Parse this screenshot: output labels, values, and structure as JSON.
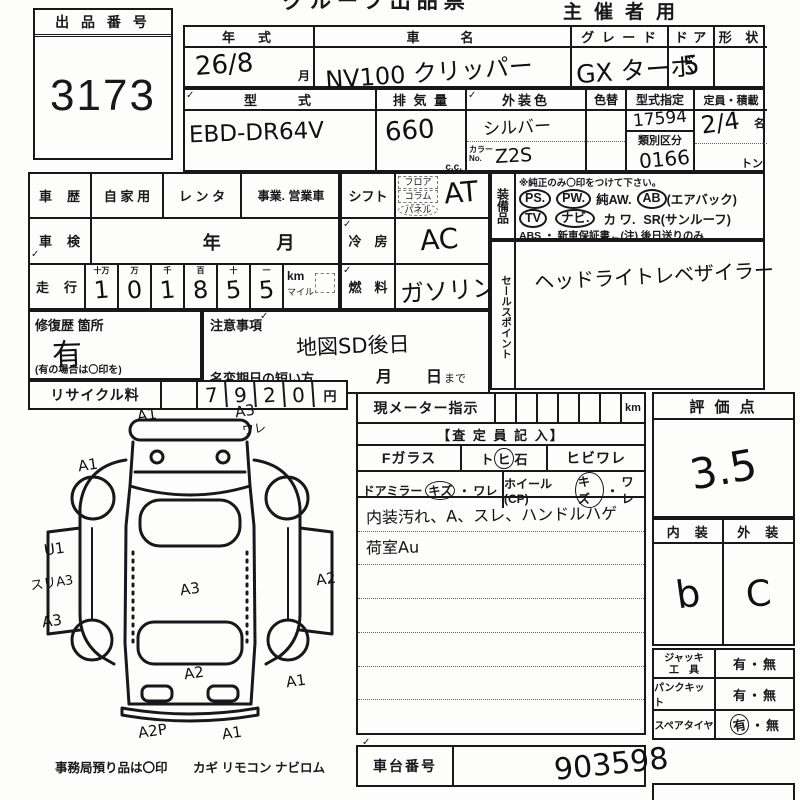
{
  "colors": {
    "paper": "#fdfdfb",
    "ink": "#17171c"
  },
  "header": {
    "title": "グループ出品票",
    "corner": "主催者用"
  },
  "marks": {
    "tick": "✓"
  },
  "exhibit": {
    "label": "出 品 番 号",
    "number": "3173"
  },
  "top": {
    "year": {
      "label": "年　式",
      "value": "26/8",
      "unit": "月"
    },
    "name": {
      "label": "車　　名",
      "value": "NV100 クリッパー"
    },
    "grade": {
      "label": "グ レ ー ド",
      "value": "GX ターボ"
    },
    "door": {
      "label": "ド ア",
      "value": "5"
    },
    "shape": {
      "label": "形 状",
      "value": ""
    },
    "model": {
      "label": "型　　式",
      "value": "EBD-DR64V"
    },
    "disp": {
      "label": "排 気 量",
      "value": "660",
      "unit": "c.c."
    },
    "color": {
      "label": "外装色",
      "value": "シルバー",
      "no_label": "カラーNo.",
      "no_value": "Z2S"
    },
    "recolor": {
      "label": "色替",
      "value": ""
    },
    "approval": {
      "label": "型式指定",
      "value": "17594",
      "sub_label": "類別区分",
      "sub_value": "0166"
    },
    "capacity": {
      "label": "定員・積載",
      "value": "2/4",
      "unit": "名",
      "ton": "トン"
    }
  },
  "history": {
    "label": "車　歴",
    "opt1": "自 家 用",
    "opt2": "レ ン タ",
    "opt3": "事業. 営業車",
    "inspection": {
      "label": "車　検",
      "year": "年",
      "month": "月"
    },
    "mileage": {
      "label": "走　行",
      "headers": [
        "十万",
        "万",
        "千",
        "百",
        "十",
        "一"
      ],
      "digits": [
        "1",
        "0",
        "1",
        "8",
        "5",
        "5"
      ],
      "km": "km",
      "mile": "マイル"
    }
  },
  "drive": {
    "shift": {
      "label": "シフト",
      "opts": [
        "フロア",
        "コラム",
        "パネル"
      ],
      "value": "AT"
    },
    "ac": {
      "label": "冷　房",
      "value": "AC"
    },
    "fuel": {
      "label": "燃　料",
      "value": "ガソリン"
    }
  },
  "equip": {
    "label": "装備品",
    "note": "※純正のみ〇印をつけて下さい。",
    "l1": [
      "PS.",
      "PW.",
      "純AW.",
      "AB",
      "(エアバック)"
    ],
    "l2": [
      "TV",
      "ナビ.",
      "カ ワ.",
      "SR(サンルーフ)"
    ],
    "l3": "ABS ・ 新車保証書←(注) 後日送りのみ"
  },
  "sales": {
    "label": "セールスポイント",
    "value": "ヘッドライトレベザイラー"
  },
  "repair": {
    "label": "修復歴 箇所",
    "value": "有",
    "note": "(有の場合は〇印を)"
  },
  "caution": {
    "label": "注意事項",
    "value": "地図SD後日",
    "rename_label": "名変期日の短い方",
    "month": "月",
    "day": "日",
    "suffix": "まで"
  },
  "recycle": {
    "label": "リサイクル料",
    "digits": [
      "7",
      "9",
      "2",
      "0"
    ],
    "unit": "円"
  },
  "diagram": {
    "annotations": [
      "A1",
      "A3",
      "ワレ",
      "A1",
      "U1",
      "スリA3",
      "A3",
      "A3",
      "A2",
      "A2",
      "A1",
      "A2P",
      "A1"
    ],
    "footer_label": "事務局預り品は〇印",
    "footer_items": "カギ リモコン ナビロム"
  },
  "meter": {
    "label": "現メーター指示",
    "unit": "km"
  },
  "assessor": {
    "header": "【査 定 員 記 入】",
    "f_glass": "Fガラス",
    "stone": [
      "ト",
      "ヒ",
      "石"
    ],
    "crack": "ヒビワレ",
    "mirror": {
      "label": "ドアミラー",
      "kizu": "キズ",
      "sep": "・",
      "ware": "ワレ"
    },
    "wheel": {
      "label": "ホイール(CP)",
      "kizu": "キズ",
      "sep": "・",
      "ware": "ワレ"
    },
    "notes": [
      "内装汚れ、A、スレ、ハンドルハゲ",
      "荷室Au"
    ]
  },
  "score": {
    "label": "評 価 点",
    "value": "3.5",
    "interior_label": "内　装",
    "exterior_label": "外　装",
    "interior": "b",
    "exterior": "C"
  },
  "tools": {
    "row1_l1": "ジャッキ",
    "row1_l2": "工　具",
    "row2": "パンクキット",
    "row3": "スペアタイヤ",
    "yes": "有",
    "sep": "・",
    "no": "無"
  },
  "chassis": {
    "label": "車台番号",
    "value": "903598"
  }
}
